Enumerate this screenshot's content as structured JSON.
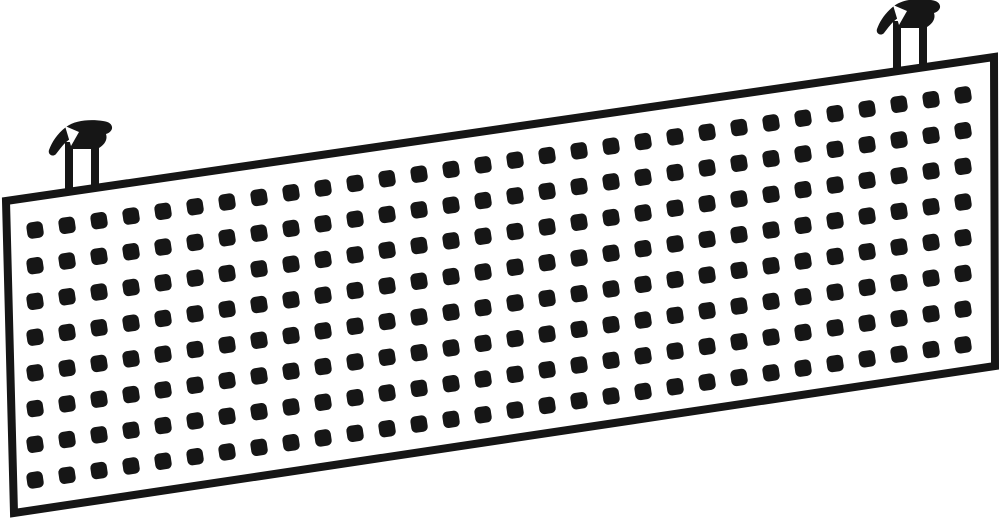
{
  "canvas": {
    "width": 1000,
    "height": 522,
    "background": "#ffffff"
  },
  "ink_color": "#161616",
  "paper_color": "#ffffff",
  "panel": {
    "description": "perforated rectangular panel shown in slight perspective, higher on the right",
    "fill": "#ffffff",
    "stroke_width": 8,
    "corners": [
      [
        6,
        201
      ],
      [
        994,
        57
      ],
      [
        995,
        366
      ],
      [
        14,
        513
      ]
    ]
  },
  "perforations": {
    "rows": 8,
    "cols": 30,
    "origin_x": 35,
    "origin_y": 230,
    "pitch_x": 32,
    "pitch_y": 35.7,
    "row_slope": -0.1455,
    "hole_size": 16.5,
    "corner_radius": 5,
    "rotation_deg": -8.4
  },
  "hooks": [
    {
      "name": "left-mounting-hook",
      "x": 82,
      "y": 192
    },
    {
      "name": "right-mounting-hook",
      "x": 910,
      "y": 71
    }
  ]
}
